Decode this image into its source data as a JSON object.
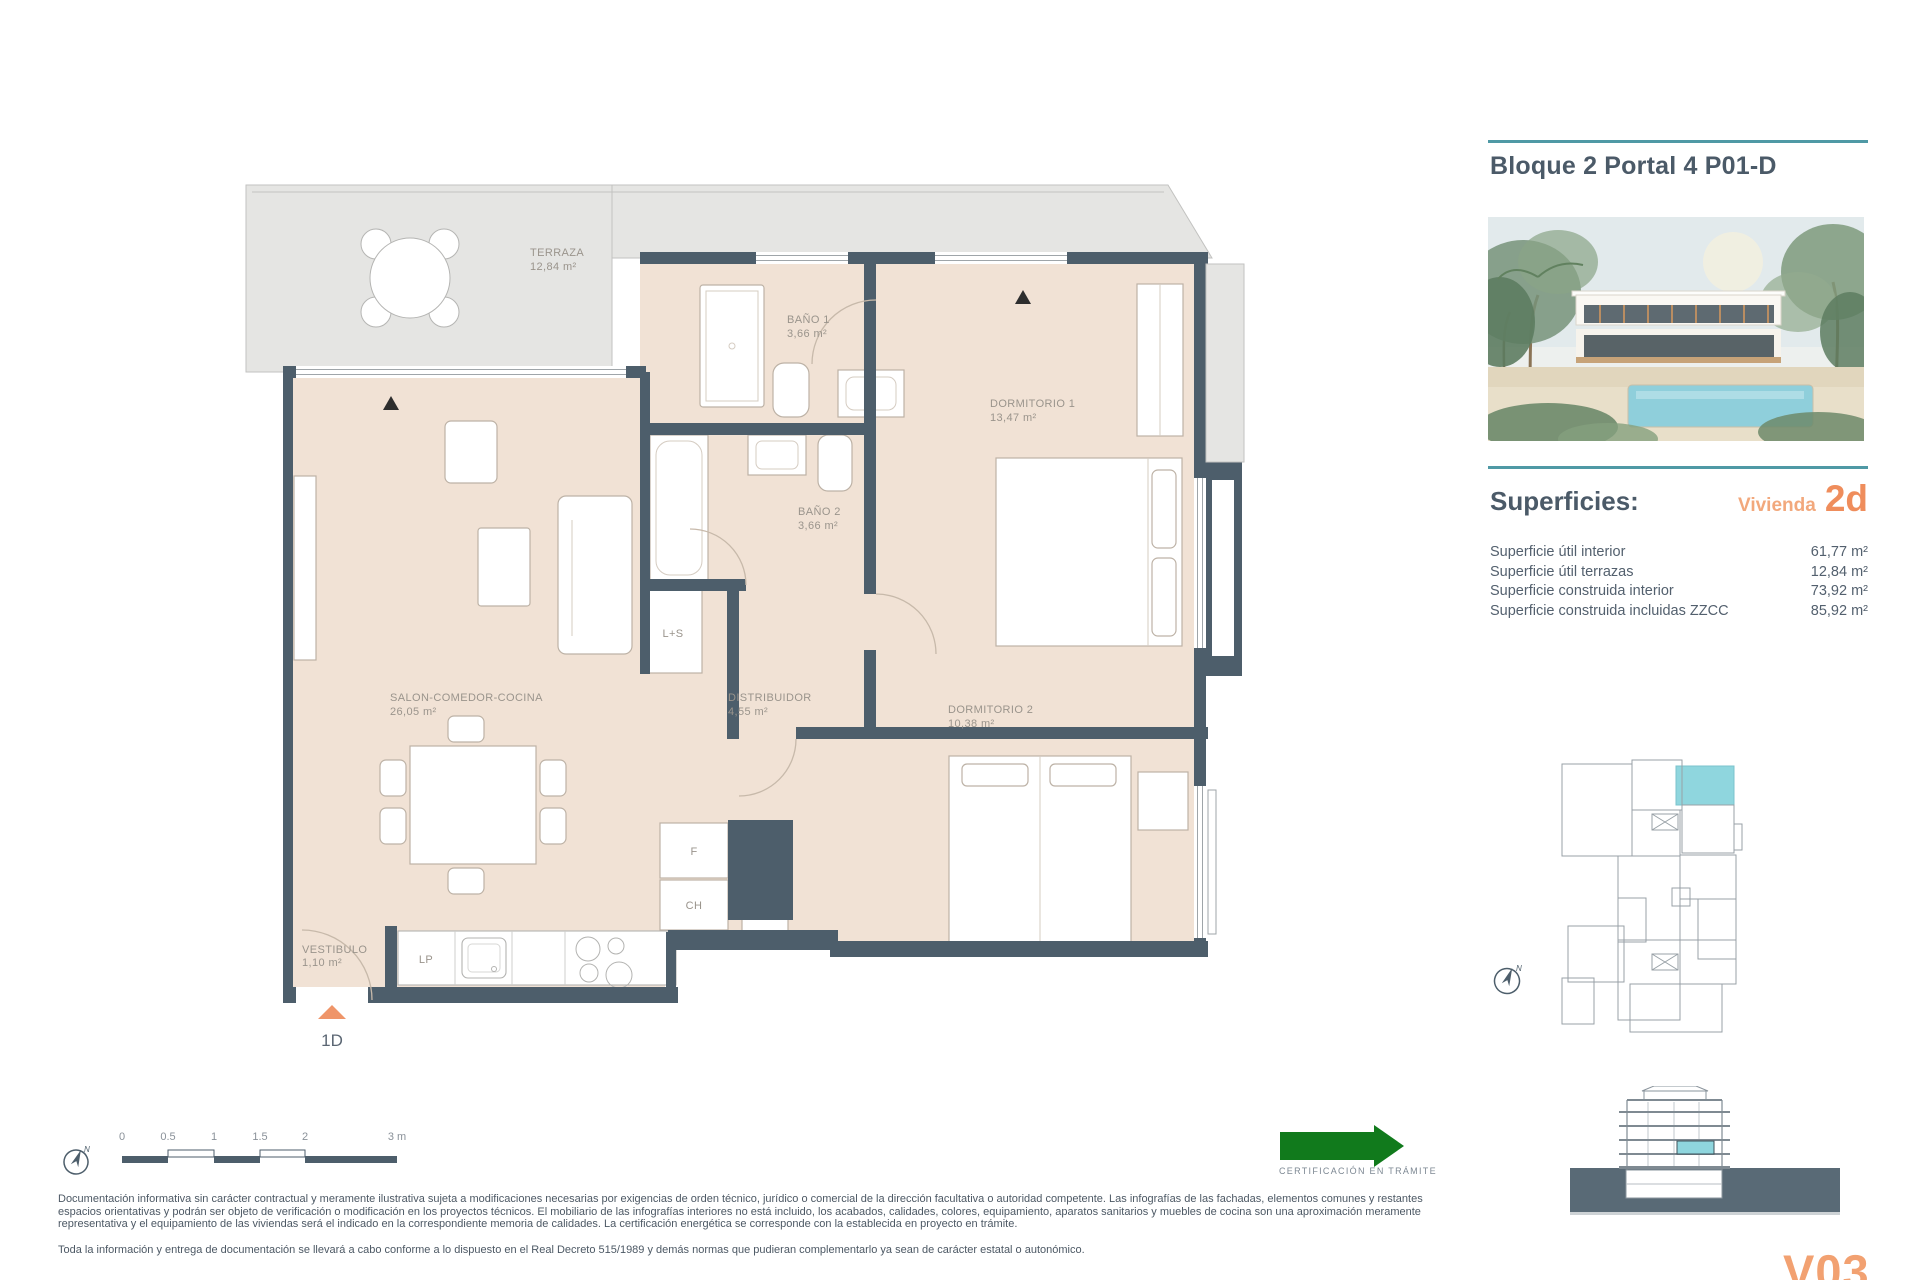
{
  "header": {
    "title": "Bloque 2 Portal 4 P01-D"
  },
  "superficies": {
    "heading": "Superficies:",
    "vivienda_label": "Vivienda",
    "vivienda_code": "2d",
    "rows": [
      {
        "label": "Superficie útil interior",
        "value": "61,77 m²"
      },
      {
        "label": "Superficie útil terrazas",
        "value": "12,84 m²"
      },
      {
        "label": "Superficie construida interior",
        "value": "73,92 m²"
      },
      {
        "label": "Superficie construida incluidas ZZCC",
        "value": "85,92 m²"
      }
    ]
  },
  "plan": {
    "rooms": {
      "terraza": {
        "name": "TERRAZA",
        "area": "12,84 m²"
      },
      "bano1": {
        "name": "BAÑO 1",
        "area": "3,66 m²"
      },
      "dormitorio1": {
        "name": "DORMITORIO 1",
        "area": "13,47 m²"
      },
      "bano2": {
        "name": "BAÑO 2",
        "area": "3,66 m²"
      },
      "salon": {
        "name": "SALON-COMEDOR-COCINA",
        "area": "26,05 m²"
      },
      "distribuidor": {
        "name": "DISTRIBUIDOR",
        "area": "4,55 m²"
      },
      "dormitorio2": {
        "name": "DORMITORIO 2",
        "area": "10,38 m²"
      },
      "vestibulo": {
        "name": "VESTIBULO",
        "area": "1,10 m²"
      }
    },
    "labels": {
      "ls": "L+S",
      "lp": "LP",
      "f": "F",
      "ch": "CH"
    },
    "entrance": "1D"
  },
  "misc": {
    "north": "N"
  },
  "scale_bar": {
    "ticks": [
      "0",
      "0.5",
      "1",
      "1.5",
      "2",
      "3 m"
    ]
  },
  "certification": {
    "label": "CERTIFICACIÓN EN TRÁMITE"
  },
  "disclaimer": {
    "p1": "Documentación informativa sin carácter contractual y meramente ilustrativa sujeta a modificaciones necesarias por exigencias de orden técnico, jurídico o comercial de la dirección facultativa o autoridad competente. Las infografías de las fachadas, elementos comunes y restantes espacios orientativas y podrán ser objeto de verificación o modificación en los proyectos técnicos. El mobiliario de las infografías interiores no está incluido, los acabados, calidades, colores, equipamiento, aparatos sanitarios y muebles de cocina son una aproximación meramente representativa y el equipamiento de las viviendas será el indicado en la correspondiente memoria de calidades. La certificación energética se corresponde con la establecida en proyecto en trámite.",
    "p2": "Toda la información y entrega de documentación se llevará a cabo conforme a lo dispuesto en el Real Decreto 515/1989 y demás normas que pudieran complementarlo ya sean de carácter estatal o autonómico."
  },
  "page": {
    "version_code": "V03"
  },
  "colors": {
    "wall": "#4d5e6b",
    "interior": "#f1e2d5",
    "terrace": "#e5e5e3",
    "accent_teal": "#4f99a5",
    "accent_orange": "#ef8d5c",
    "unit_highlight": "#8fd6de",
    "cert_green": "#117a1c"
  }
}
